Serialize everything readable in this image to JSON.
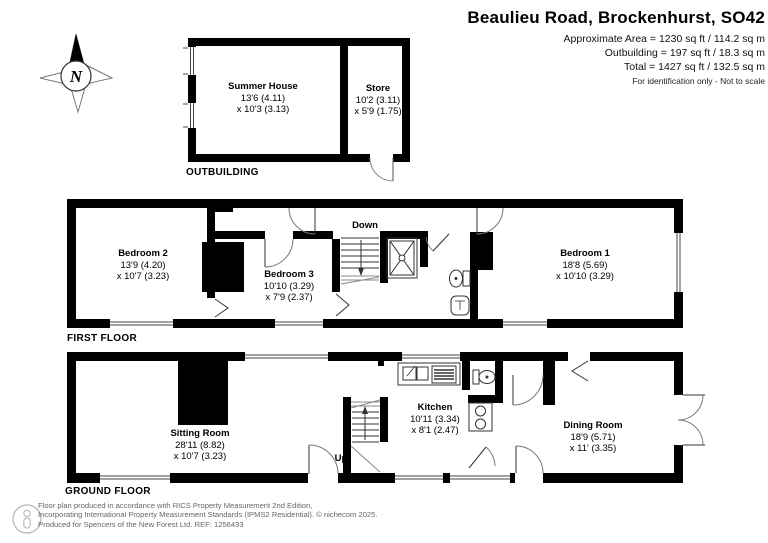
{
  "header": {
    "title": "Beaulieu Road, Brockenhurst, SO42",
    "area_line": "Approximate Area = 1230 sq ft / 114.2 sq m",
    "outbuilding_line": "Outbuilding = 197 sq ft / 18.3 sq m",
    "total_line": "Total = 1427 sq ft / 132.5 sq m",
    "disclaimer": "For identification only - Not to scale"
  },
  "compass": {
    "north_label": "N"
  },
  "outbuilding": {
    "section_label": "OUTBUILDING",
    "rooms": [
      {
        "name": "Summer House",
        "dim1": "13'6 (4.11)",
        "dim2": "x 10'3 (3.13)"
      },
      {
        "name": "Store",
        "dim1": "10'2 (3.11)",
        "dim2": "x 5'9 (1.75)"
      }
    ]
  },
  "first_floor": {
    "section_label": "FIRST FLOOR",
    "stairs_label": "Down",
    "rooms": [
      {
        "name": "Bedroom 2",
        "dim1": "13'9 (4.20)",
        "dim2": "x 10'7 (3.23)"
      },
      {
        "name": "Bedroom 3",
        "dim1": "10'10 (3.29)",
        "dim2": "x 7'9 (2.37)"
      },
      {
        "name": "Bedroom 1",
        "dim1": "18'8 (5.69)",
        "dim2": "x 10'10 (3.29)"
      }
    ]
  },
  "ground_floor": {
    "section_label": "GROUND FLOOR",
    "stairs_label": "Up",
    "rooms": [
      {
        "name": "Sitting Room",
        "dim1": "28'11 (8.82)",
        "dim2": "x 10'7 (3.23)"
      },
      {
        "name": "Kitchen",
        "dim1": "10'11 (3.34)",
        "dim2": "x 8'1 (2.47)"
      },
      {
        "name": "Dining Room",
        "dim1": "18'9 (5.71)",
        "dim2": "x 11' (3.35)"
      }
    ]
  },
  "footer": {
    "line1": "Floor plan produced in accordance with RICS Property Measurement 2nd Edition,",
    "line2": "Incorporating International Property Measurement Standards (IPMS2 Residential).   © nichecom 2025.",
    "line3": "Produced for Spencers of the New Forest Ltd.   REF:  1256433"
  }
}
